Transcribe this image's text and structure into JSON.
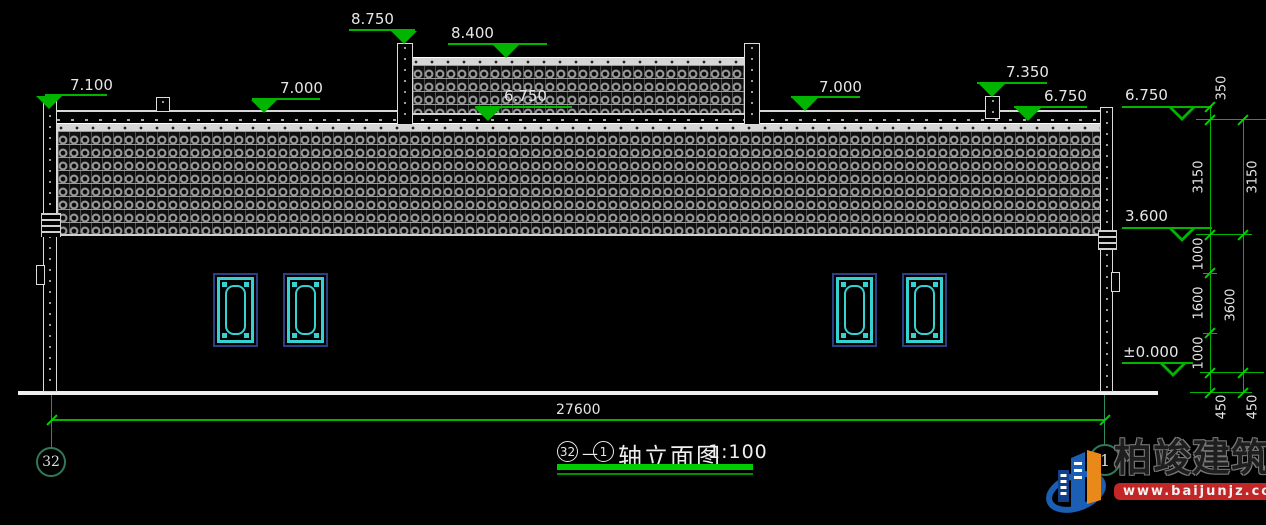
{
  "title_block": {
    "axis_start": "32",
    "separator": "—",
    "axis_end": "1",
    "name": "轴立面图",
    "scale": "1:100"
  },
  "elevation_markers": [
    {
      "label": "7.100"
    },
    {
      "label": "7.000"
    },
    {
      "label": "8.750"
    },
    {
      "label": "8.400"
    },
    {
      "label": "6.750"
    },
    {
      "label": "7.000"
    },
    {
      "label": "7.350"
    },
    {
      "label": "6.750"
    },
    {
      "label": "6.750"
    },
    {
      "label": "3.600"
    },
    {
      "label": "±0.000"
    }
  ],
  "dimensions": {
    "total_width": "27600",
    "right_inner": [
      "350",
      "3150",
      "1000",
      "1600",
      "1000",
      "450"
    ],
    "right_outer": [
      "3150",
      "3600",
      "450"
    ]
  },
  "axis_bubbles": {
    "left": "32",
    "right": "1"
  },
  "watermark": {
    "name": "柏竣建筑",
    "url": "www.baijunjz.com"
  },
  "colors": {
    "dimension_green": "#00b400",
    "axis_teal": "#2f7a58",
    "window_cyan": "#36d2d2",
    "window_blue": "#2b3f85",
    "line_white": "#e8e8e8",
    "underline_green": "#00cc00",
    "watermark_red": "#c22626",
    "watermark_blue": "#1a5fb4",
    "watermark_orange": "#e8891a"
  }
}
